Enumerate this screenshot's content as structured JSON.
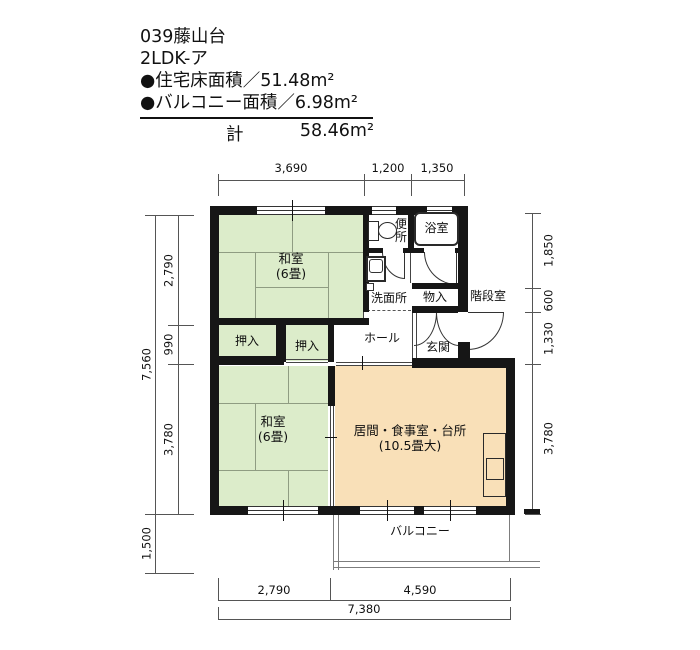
{
  "header": {
    "project": "039藤山台",
    "layout_type": "2LDK-ア",
    "floor_area_line": "●住宅床面積／51.48m²",
    "balcony_area_line": "●バルコニー面積／6.98m²",
    "total_label": "計",
    "total_value": "58.46m²"
  },
  "dimensions": {
    "top": [
      "3,690",
      "1,200",
      "1,350"
    ],
    "left": [
      "2,790",
      "990",
      "3,780"
    ],
    "left_total": "7,560",
    "left_balcony": "1,500",
    "right": [
      "1,850",
      "600",
      "1,330",
      "3,780"
    ],
    "bottom": [
      "2,790",
      "4,590"
    ],
    "bottom_total": "7,380"
  },
  "rooms": {
    "washitsu1": {
      "name": "和室",
      "size": "(6畳)"
    },
    "washitsu2": {
      "name": "和室",
      "size": "(6畳)"
    },
    "ldk": {
      "name": "居間・食事室・台所",
      "size": "(10.5畳大)"
    },
    "closet1": "押入",
    "closet2": "押入",
    "toilet": "便所",
    "bath": "浴室",
    "washroom": "洗面所",
    "storage": "物入",
    "hall": "ホール",
    "entrance": "玄関",
    "stairwell": "階段室",
    "balcony": "バルコニー"
  },
  "colors": {
    "tatami": "#dcecca",
    "ldk": "#f9e0b8",
    "wall": "#161616"
  }
}
